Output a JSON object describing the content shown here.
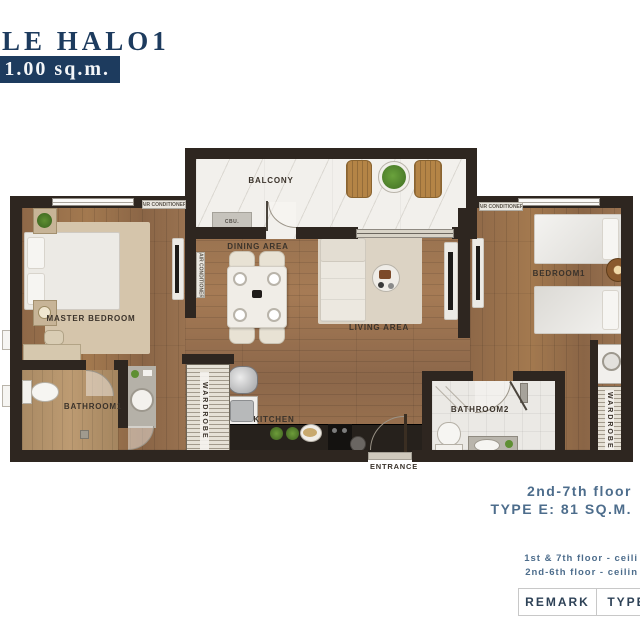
{
  "header": {
    "project_name": "LE HALO1",
    "area_badge": "1.00 sq.m."
  },
  "plan": {
    "labels": {
      "balcony": "BALCONY",
      "cbu": "CBU.",
      "dining": "DINING AREA",
      "living": "LIVING AREA",
      "master_bedroom": "MASTER BEDROOM",
      "bedroom1": "BEDROOM1",
      "bathroom1": "BATHROOM1",
      "bathroom2": "BATHROOM2",
      "kitchen": "KITCHEN",
      "entrance": "ENTRANCE",
      "wardrobe": "WARDROBE",
      "air_conditioner": "AIR CONDITIONER"
    }
  },
  "footer": {
    "floor_range": "2nd-7th floor",
    "unit_type": "TYPE E: 81 SQ.M.",
    "remark_note_1": "1st & 7th floor -  ceili",
    "remark_note_2": "2nd-6th floor - ceilin",
    "table": {
      "remark_header": "REMARK",
      "type_header": "TYPE"
    }
  },
  "colors": {
    "brand_navy": "#1d3b5e",
    "footer_blue": "#4d6d8c",
    "wall_dark": "#2e2620",
    "wood": "#9a7351"
  }
}
